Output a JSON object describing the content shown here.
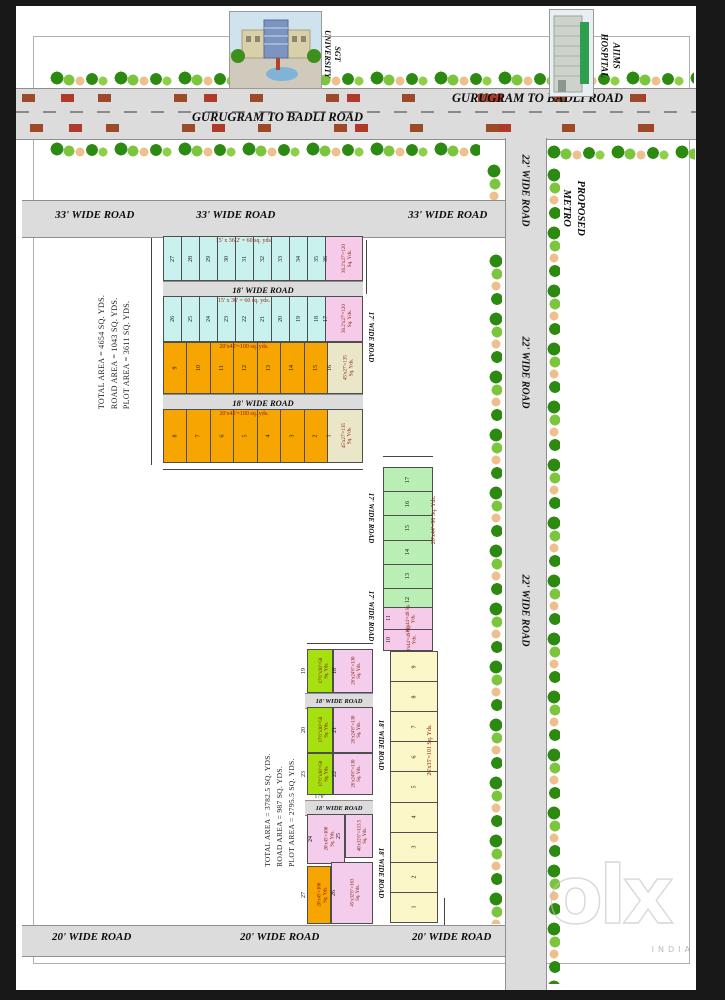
{
  "palette": {
    "road": "#dcdcdc",
    "cyan": "#c9f2ef",
    "pink": "#f6cbe9",
    "orange": "#f7a500",
    "beige": "#eae6c8",
    "green": "#b9eeb4",
    "lime": "#a6e011",
    "rose": "#f3cdeb",
    "yellow": "#fcf7c9",
    "tree_dark": "#2d8a10",
    "tree_light": "#7cc63e",
    "tree_tan": "#eec08f",
    "title_red": "#9e1a06"
  },
  "landmarks": {
    "sgt_line1": "SGT",
    "sgt_line2": "UNIVERSITY",
    "aiims_line1": "AIIMS",
    "aiims_line2": "HOSPITAL",
    "metro_line1": "PROPOSED",
    "metro_line2": "METRO"
  },
  "top_road": {
    "label_upper": "GURUGRAM TO BADLI ROAD",
    "label_lower": "GURUGRAM TO BADLI ROAD"
  },
  "road_labels": {
    "r33_1": "33' WIDE ROAD",
    "r33_2": "33' WIDE ROAD",
    "r33_3": "33' WIDE ROAD",
    "r22_top": "22' WIDE ROAD",
    "r22_mid": "22' WIDE ROAD",
    "r22_bot": "22' WIDE ROAD",
    "r20_1": "20' WIDE ROAD",
    "r20_2": "20' WIDE ROAD",
    "r20_3": "20' WIDE ROAD",
    "r18_h1": "18' WIDE ROAD",
    "r18_h2": "18' WIDE ROAD",
    "r18_h3": "18' WIDE ROAD",
    "r18_h4": "18' WIDE ROAD",
    "r18_v1": "18' WIDE ROAD",
    "r18_v2": "18' WIDE ROAD",
    "r17_v1": "17' WIDE ROAD",
    "r17_v2": "17' WIDE ROAD",
    "r17_v3": "17' WIDE ROAD"
  },
  "area_summary_left": {
    "l1": "TOTAL AREA = 4654 SQ. YDS.",
    "l2": "ROAD AREA = 1043 SQ. YDS.",
    "l3": "PLOT AREA = 3611 SQ. YDS."
  },
  "area_summary_bottom": {
    "l1": "TOTAL AREA = 3782.5 SQ. YDS.",
    "l2": "ROAD AREA = 987 SQ. YDS.",
    "l3": "PLOT AREA = 2795.5 SQ. YDS."
  },
  "block_top": {
    "row1": {
      "title": "15' x 36.2' = 60 sq. yds.",
      "plots": [
        "27",
        "28",
        "29",
        "30",
        "31",
        "32",
        "33",
        "34",
        "35"
      ],
      "end": {
        "num": "36",
        "label": "36.2'x27'=120 Sq. Yds."
      }
    },
    "row2": {
      "title": "15' x 36' = 60 sq. yds.",
      "plots": [
        "26",
        "25",
        "24",
        "23",
        "22",
        "21",
        "20",
        "19",
        "18"
      ],
      "end": {
        "num": "17",
        "label": "36.2'x27'=120 Sq. Yds."
      }
    },
    "row3": {
      "title": "20'x45'=100 sq. yds.",
      "plots": [
        "9",
        "10",
        "11",
        "12",
        "13",
        "14",
        "15"
      ],
      "end": {
        "num": "16",
        "label": "45'x27'=135 Sq. Yds."
      }
    },
    "row4": {
      "title": "20'x45'=100 sq. yds.",
      "plots": [
        "8",
        "7",
        "6",
        "5",
        "4",
        "3",
        "2"
      ],
      "end": {
        "num": "1",
        "label": "45'x27'=135 Sq. Yds."
      }
    }
  },
  "strip_green": {
    "label": "20'x44'=98 Sq. Yds.",
    "plots": [
      "17",
      "16",
      "15",
      "14",
      "13",
      "12"
    ]
  },
  "strip_pink": {
    "plots": [
      {
        "num": "11",
        "label": "10'x44'=49 Sq. Yds."
      },
      {
        "num": "10",
        "label": "10'x44'=49 Sq. Yds."
      }
    ]
  },
  "strip_yellow": {
    "label": "26'x35'=101 Sq. Yds.",
    "plots": [
      "9",
      "8",
      "7",
      "6",
      "5",
      "4",
      "3",
      "2",
      "1"
    ]
  },
  "block_bottom": {
    "rowA": {
      "green": {
        "num": "19",
        "label": "17'6\"x30'=58 Sq. Yds."
      },
      "pink": {
        "num": "18",
        "label": "26'x24'6\"=130 Sq. Yds."
      }
    },
    "rowB": {
      "green": {
        "num": "20",
        "label": "17'6\"x30'=58 Sq. Yds."
      },
      "pink": {
        "num": "21",
        "label": "26'x24'6\"=130 Sq. Yds."
      }
    },
    "rowC": {
      "green": {
        "num": "23",
        "label": "17'6\"x30'=58 Sq. Yds."
      },
      "pink": {
        "num": "22",
        "label": "26'x24'6\"=130 Sq. Yds."
      }
    },
    "dim_note": "17'6\"",
    "rowD": {
      "left": {
        "num": "24",
        "label": "20'x45'=100 Sq. Yds."
      },
      "right": {
        "num": "25",
        "label": "40'x32'6\"=113.5 Sq. Yds."
      }
    },
    "rowE": {
      "left": {
        "num": "27",
        "label": "20'x45'=100 Sq. Yds."
      },
      "right": {
        "num": "26",
        "label": "45'x32'6\"=163 Sq. Yds."
      }
    }
  },
  "watermark": {
    "brand": "olx",
    "country": "INDIA"
  }
}
